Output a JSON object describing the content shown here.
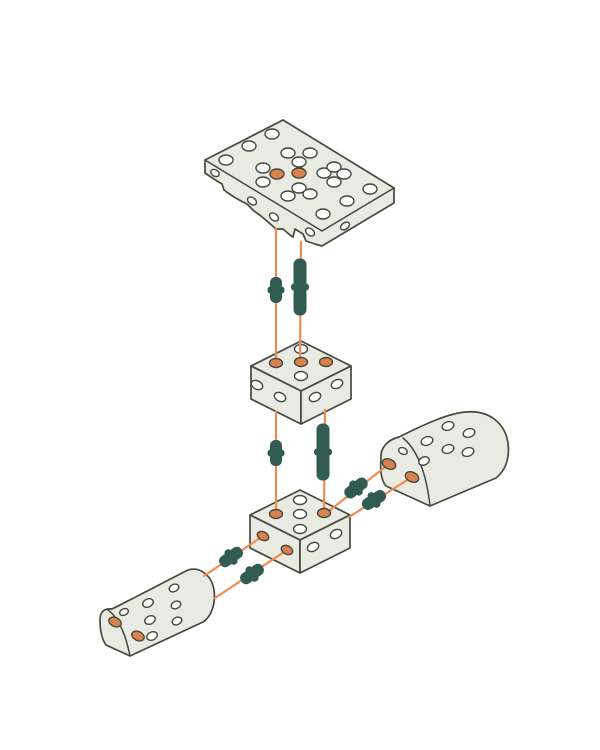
{
  "meta": {
    "title": "Exploded assembly diagram",
    "description": "Isometric exploded-view diagram of five perforated light-gray construction blocks joined by orange guide lines and dark teal connector pins",
    "background": "#ffffff"
  },
  "colors": {
    "part-fill": "#e9eae2",
    "part-outline": "#45493f",
    "hole-fill": "#ffffff",
    "hole-accent": "#d9824e",
    "guide-line": "#ef8a52",
    "pin": "#315b53"
  },
  "parts": [
    {
      "id": "top-plate",
      "label": "perforated flat plate",
      "accent_holes": 2
    },
    {
      "id": "middle-block",
      "label": "perforated cube block",
      "accent_holes": 3
    },
    {
      "id": "bottom-block",
      "label": "perforated cube block",
      "accent_holes": 4
    },
    {
      "id": "right-half-cylinder",
      "label": "perforated half-cylinder block",
      "accent_holes": 2
    },
    {
      "id": "left-half-cylinder",
      "label": "perforated half-cylinder block",
      "accent_holes": 2
    }
  ],
  "connectors": {
    "short_pins": 6,
    "long_pins": 2,
    "guide_lines": 8
  }
}
